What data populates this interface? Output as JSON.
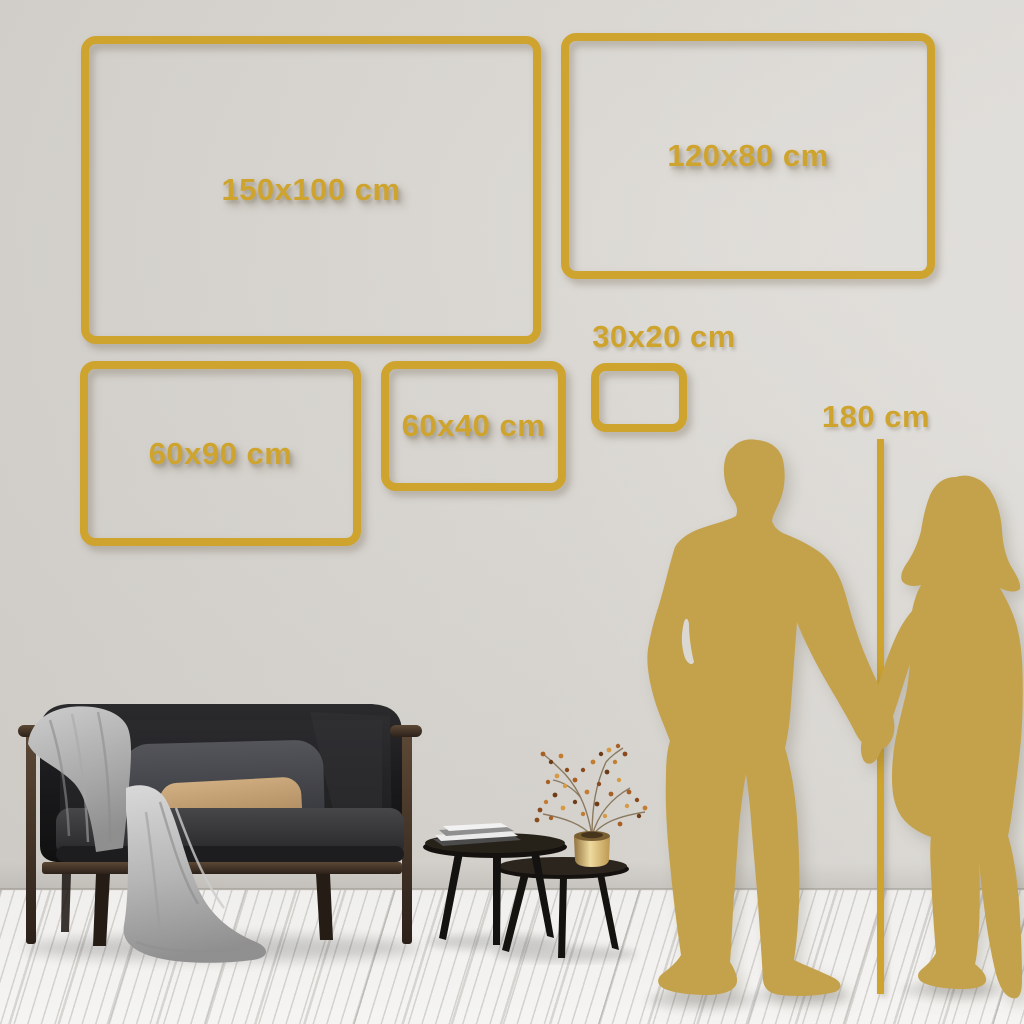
{
  "size_guide": {
    "frames": [
      {
        "id": "150x100",
        "label": "150x100 cm"
      },
      {
        "id": "120x80",
        "label": "120x80 cm"
      },
      {
        "id": "60x90",
        "label": "60x90 cm"
      },
      {
        "id": "60x40",
        "label": "60x40 cm"
      },
      {
        "id": "30x20",
        "label": "30x20 cm"
      }
    ],
    "height_reference": {
      "label": "180 cm"
    }
  },
  "colors": {
    "accent_gold": "#cfa42e",
    "silhouette_gold": "#c4a14b",
    "wall": "#d6d3ce",
    "floor": "#f0efed"
  },
  "scene": {
    "furniture": [
      "sofa",
      "gray-blanket",
      "back-pillow",
      "tan-pillow",
      "coffee-table-tall",
      "coffee-table-low",
      "books",
      "gold-vase",
      "dried-flower-branches"
    ],
    "figures": [
      "man-silhouette",
      "woman-silhouette"
    ]
  }
}
